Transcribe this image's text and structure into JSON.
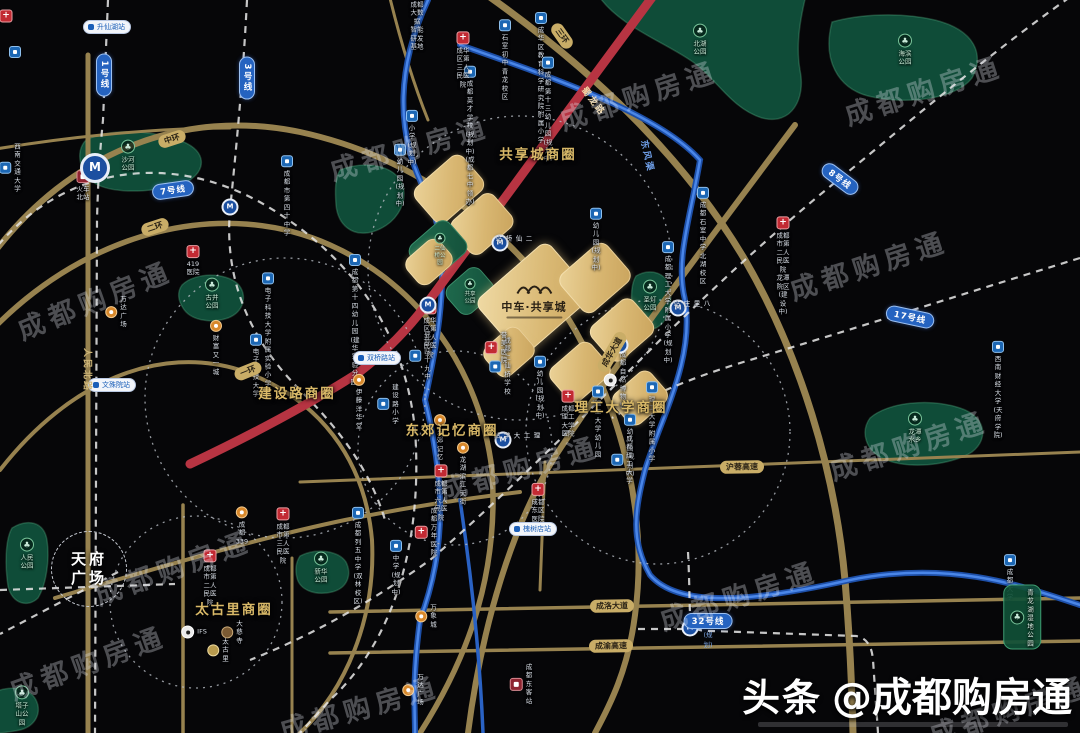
{
  "watermark": "成都购房通",
  "brand": {
    "prefix": "头条",
    "handle": "@成都购房通"
  },
  "project": {
    "name": "中车·共享城"
  },
  "tianfu": {
    "line1": "天府",
    "line2": "广场"
  },
  "colors": {
    "road_gold": "#97824f",
    "red_line": "#b73442",
    "river_blue": "#2a62c4",
    "metro_pill": "#2563c0",
    "parcel_gold": "#ddbd78",
    "park_green": "#14503a",
    "biz_label": "#d9b968"
  },
  "business_circles": [
    {
      "label": "共享城商圈",
      "x": 538,
      "y": 153
    },
    {
      "label": "建设路商圈",
      "x": 297,
      "y": 392
    },
    {
      "label": "东郊记忆商圈",
      "x": 452,
      "y": 429
    },
    {
      "label": "理工大学商圈",
      "x": 621,
      "y": 406
    },
    {
      "label": "太古里商圈",
      "x": 234,
      "y": 608
    }
  ],
  "line_pills": [
    {
      "label": "1号线",
      "x": 104,
      "y": 75,
      "vert": true
    },
    {
      "label": "3号线",
      "x": 247,
      "y": 78,
      "vert": true
    },
    {
      "label": "7号线",
      "x": 173,
      "y": 190,
      "rot": -8
    },
    {
      "label": "8号线",
      "x": 840,
      "y": 179,
      "rot": 37
    },
    {
      "label": "17号线",
      "x": 910,
      "y": 317,
      "rot": 12
    },
    {
      "label": "32号线",
      "x": 708,
      "y": 621,
      "rot": 0,
      "sub": "(规划)"
    }
  ],
  "road_labels": [
    {
      "label": "中环",
      "x": 172,
      "y": 139,
      "rot": -18,
      "style": "pill"
    },
    {
      "label": "二环",
      "x": 155,
      "y": 227,
      "rot": -18,
      "style": "pill"
    },
    {
      "label": "一环",
      "x": 248,
      "y": 371,
      "rot": -22,
      "style": "pill"
    },
    {
      "label": "三环",
      "x": 562,
      "y": 36,
      "rot": 55,
      "style": "pill"
    },
    {
      "label": "成华大道",
      "x": 612,
      "y": 352,
      "rot": -60,
      "style": "pill"
    },
    {
      "label": "沪蓉高速",
      "x": 742,
      "y": 467,
      "rot": -1,
      "style": "pill"
    },
    {
      "label": "成洛大道",
      "x": 612,
      "y": 606,
      "rot": -1,
      "style": "pill"
    },
    {
      "label": "成渝高速",
      "x": 611,
      "y": 646,
      "rot": -1,
      "style": "pill"
    },
    {
      "label": "人民北路",
      "x": 88,
      "y": 370,
      "rot": 90,
      "style": "text",
      "color": "#cdb578"
    },
    {
      "label": "蜀龙路",
      "x": 594,
      "y": 101,
      "rot": 53,
      "style": "text",
      "color": "#f2d9a8"
    },
    {
      "label": "东风渠",
      "x": 648,
      "y": 156,
      "rot": 78,
      "style": "text",
      "color": "#6f9fe8"
    }
  ],
  "stations": [
    {
      "x": 95,
      "y": 168,
      "big": true
    },
    {
      "x": 230,
      "y": 207
    },
    {
      "x": 500,
      "y": 243,
      "label": "二仙桥站",
      "lx": 513,
      "ly": 235
    },
    {
      "x": 428,
      "y": 305
    },
    {
      "x": 678,
      "y": 308,
      "label": "八里庄站",
      "lx": 691,
      "ly": 300
    },
    {
      "x": 620,
      "y": 345
    },
    {
      "x": 503,
      "y": 440,
      "label": "理工大学站",
      "lx": 516,
      "ly": 432
    },
    {
      "x": 690,
      "y": 628
    }
  ],
  "station_pills": [
    {
      "label": "升仙湖站",
      "x": 107,
      "y": 27
    },
    {
      "label": "文殊院站",
      "x": 112,
      "y": 385
    },
    {
      "label": "双桥路站",
      "x": 377,
      "y": 358
    },
    {
      "label": "槐树店站",
      "x": 533,
      "y": 529
    }
  ],
  "parcels": [
    {
      "kind": "gold",
      "x": 449,
      "y": 189,
      "w": 64,
      "h": 46
    },
    {
      "kind": "gold",
      "x": 482,
      "y": 224,
      "w": 56,
      "h": 44
    },
    {
      "kind": "green",
      "x": 438,
      "y": 249,
      "w": 52,
      "h": 42
    },
    {
      "kind": "gold",
      "x": 429,
      "y": 262,
      "w": 44,
      "h": 34
    },
    {
      "kind": "green",
      "x": 470,
      "y": 291,
      "w": 44,
      "h": 36
    },
    {
      "kind": "plogo",
      "x": 534,
      "y": 299,
      "w": 96,
      "h": 74
    },
    {
      "kind": "gold",
      "x": 595,
      "y": 278,
      "w": 62,
      "h": 50
    },
    {
      "kind": "gold",
      "x": 622,
      "y": 330,
      "w": 56,
      "h": 46
    },
    {
      "kind": "gold",
      "x": 580,
      "y": 372,
      "w": 54,
      "h": 44
    },
    {
      "kind": "gold",
      "x": 640,
      "y": 398,
      "w": 50,
      "h": 40
    },
    {
      "kind": "gold",
      "x": 509,
      "y": 352,
      "w": 46,
      "h": 38
    }
  ],
  "parks": [
    {
      "label": "北湖公园",
      "x": 700,
      "y": 40
    },
    {
      "label": "海滨公园",
      "x": 905,
      "y": 50
    },
    {
      "label": "沙河公园",
      "x": 128,
      "y": 156
    },
    {
      "label": "古井公园",
      "x": 212,
      "y": 294
    },
    {
      "label": "人民公园",
      "x": 27,
      "y": 554
    },
    {
      "label": "新华公园",
      "x": 321,
      "y": 568
    },
    {
      "label": "圣灯公园",
      "x": 650,
      "y": 296
    },
    {
      "label": "龙潭水乡",
      "x": 915,
      "y": 428
    },
    {
      "label": "塔子山公园",
      "x": 22,
      "y": 706
    },
    {
      "label": "二仙桥公园",
      "x": 440,
      "y": 250,
      "mini": true
    },
    {
      "label": "共享公园",
      "x": 470,
      "y": 292,
      "mini": true
    },
    {
      "label": "青龙湖湿地公园",
      "x": 1022,
      "y": 617,
      "pill": true
    }
  ],
  "pois": [
    {
      "t": "school",
      "l": "西南交通大学",
      "x": 10,
      "y": 168,
      "s": "r"
    },
    {
      "t": "school",
      "l": "成都市第四十中学",
      "x": 287,
      "y": 196
    },
    {
      "t": "school",
      "l": "石室初中\n青龙校区",
      "x": 505,
      "y": 60
    },
    {
      "t": "school",
      "l": "成华区教育科学\n研究院附属小学",
      "x": 541,
      "y": 78
    },
    {
      "t": "school",
      "l": "成都第十三幼儿园\n(规划中)",
      "x": 548,
      "y": 110
    },
    {
      "t": "school",
      "l": "成都英才学校(规划中)\n(成都七中领办)",
      "x": 470,
      "y": 136
    },
    {
      "t": "school",
      "l": "小学\n(规划中)",
      "x": 412,
      "y": 138
    },
    {
      "t": "school",
      "l": "幼儿园\n(规划中)",
      "x": 400,
      "y": 176
    },
    {
      "t": "school",
      "l": "幼儿园\n(规划中)",
      "x": 596,
      "y": 240
    },
    {
      "t": "school",
      "l": "幼儿园\n(规划中)",
      "x": 540,
      "y": 388
    },
    {
      "t": "school",
      "l": "幼儿园\n(规划中)",
      "x": 630,
      "y": 446
    },
    {
      "t": "school",
      "l": "成都石室中学\n北湖校区",
      "x": 703,
      "y": 236
    },
    {
      "t": "school",
      "l": "成都二仙桥学校",
      "x": 500,
      "y": 366,
      "s": "r"
    },
    {
      "t": "school",
      "l": "建设路小学",
      "x": 388,
      "y": 404,
      "s": "r"
    },
    {
      "t": "school",
      "l": "电子科技大学\n附属实验小学",
      "x": 268,
      "y": 330
    },
    {
      "t": "school",
      "l": "电子科技大学",
      "x": 256,
      "y": 366
    },
    {
      "t": "school",
      "l": "成都第十四幼儿园\n(建华实验分园)",
      "x": 355,
      "y": 320
    },
    {
      "t": "school",
      "l": "理工大学幼儿园",
      "x": 598,
      "y": 422
    },
    {
      "t": "school",
      "l": "成都理工大学\n附属小学(规划中)",
      "x": 668,
      "y": 303
    },
    {
      "t": "school",
      "l": "理工大学附属小学",
      "x": 652,
      "y": 422
    },
    {
      "t": "school",
      "l": "成都理工大学",
      "x": 622,
      "y": 460,
      "s": "r"
    },
    {
      "t": "school",
      "l": "西南财经大学\n(天府学院)",
      "x": 998,
      "y": 390
    },
    {
      "t": "school",
      "l": "成都大学",
      "x": 1010,
      "y": 578
    },
    {
      "t": "school",
      "l": "成都列五中学\n(双林校区)",
      "x": 358,
      "y": 556
    },
    {
      "t": "school",
      "l": "中学\n(规划中)",
      "x": 396,
      "y": 568
    },
    {
      "t": "school",
      "l": "成都四十九中",
      "x": 420,
      "y": 356,
      "s": "r"
    },
    {
      "t": "hospital",
      "l": "成华区第三人民医院",
      "x": 463,
      "y": 60
    },
    {
      "t": "hospital",
      "l": "成都市第二人民医院\n龙潭院区(建设中)",
      "x": 783,
      "y": 266
    },
    {
      "t": "hospital",
      "l": "419医院",
      "x": 193,
      "y": 261
    },
    {
      "t": "hospital",
      "l": "成华区第五人民医院",
      "x": 430,
      "y": 330
    },
    {
      "t": "hospital",
      "l": "誉美医院",
      "x": 496,
      "y": 348,
      "s": "r"
    },
    {
      "t": "hospital",
      "l": "成都理工大学医院",
      "x": 568,
      "y": 414
    },
    {
      "t": "hospital",
      "l": "成都市第六人民医院",
      "x": 441,
      "y": 493
    },
    {
      "t": "hospital",
      "l": "成都东区医院",
      "x": 538,
      "y": 503
    },
    {
      "t": "hospital",
      "l": "成都万年医院",
      "x": 426,
      "y": 532,
      "s": "r"
    },
    {
      "t": "hospital",
      "l": "成都市第二人民医院",
      "x": 210,
      "y": 578
    },
    {
      "t": "hospital",
      "l": "成都市第三人民医院",
      "x": 283,
      "y": 536
    },
    {
      "t": "mall",
      "l": "万达广场",
      "x": 116,
      "y": 312,
      "s": "r"
    },
    {
      "t": "mall",
      "l": "财富又一城",
      "x": 216,
      "y": 348
    },
    {
      "t": "mall",
      "l": "伊藤洋华堂",
      "x": 359,
      "y": 402
    },
    {
      "t": "mall",
      "l": "东郊记忆",
      "x": 440,
      "y": 438
    },
    {
      "t": "mall",
      "l": "龙湖滨江天街",
      "x": 463,
      "y": 474
    },
    {
      "t": "mall",
      "l": "万象城",
      "x": 426,
      "y": 616,
      "s": "r"
    },
    {
      "t": "mall",
      "l": "万达广场",
      "x": 413,
      "y": 690,
      "s": "r"
    },
    {
      "t": "mall",
      "l": "成都339",
      "x": 242,
      "y": 526
    },
    {
      "t": "white",
      "l": "IFS",
      "x": 194,
      "y": 632,
      "s": "r"
    },
    {
      "t": "brown",
      "l": "大慈寺",
      "x": 232,
      "y": 632,
      "s": "r"
    },
    {
      "t": "goldic",
      "l": "太古里",
      "x": 218,
      "y": 650,
      "s": "r"
    },
    {
      "t": "white",
      "l": "成都自然博物馆",
      "x": 615,
      "y": 380,
      "s": "r"
    },
    {
      "t": "tower",
      "l": "成都大数据\n智能研发基地",
      "x": 417,
      "y": 16
    },
    {
      "t": "train",
      "l": "火车北站",
      "x": 83,
      "y": 186
    },
    {
      "t": "train",
      "l": "成都东客站",
      "x": 521,
      "y": 684,
      "s": "r"
    },
    {
      "t": "hospital",
      "l": "",
      "x": 6,
      "y": 16
    },
    {
      "t": "school",
      "l": "",
      "x": 15,
      "y": 52
    }
  ],
  "watermarks": [
    {
      "x": 18,
      "y": 310,
      "rot": -22
    },
    {
      "x": 330,
      "y": 150,
      "rot": -16
    },
    {
      "x": 560,
      "y": 100,
      "rot": -18
    },
    {
      "x": 845,
      "y": 95,
      "rot": -18
    },
    {
      "x": 790,
      "y": 270,
      "rot": -18
    },
    {
      "x": 830,
      "y": 450,
      "rot": -18
    },
    {
      "x": 440,
      "y": 470,
      "rot": -16
    },
    {
      "x": 95,
      "y": 575,
      "rot": -20
    },
    {
      "x": 660,
      "y": 600,
      "rot": -18
    },
    {
      "x": 280,
      "y": 710,
      "rot": -16
    },
    {
      "x": 930,
      "y": 715,
      "rot": -18
    },
    {
      "x": 10,
      "y": 670,
      "rot": -20
    }
  ]
}
